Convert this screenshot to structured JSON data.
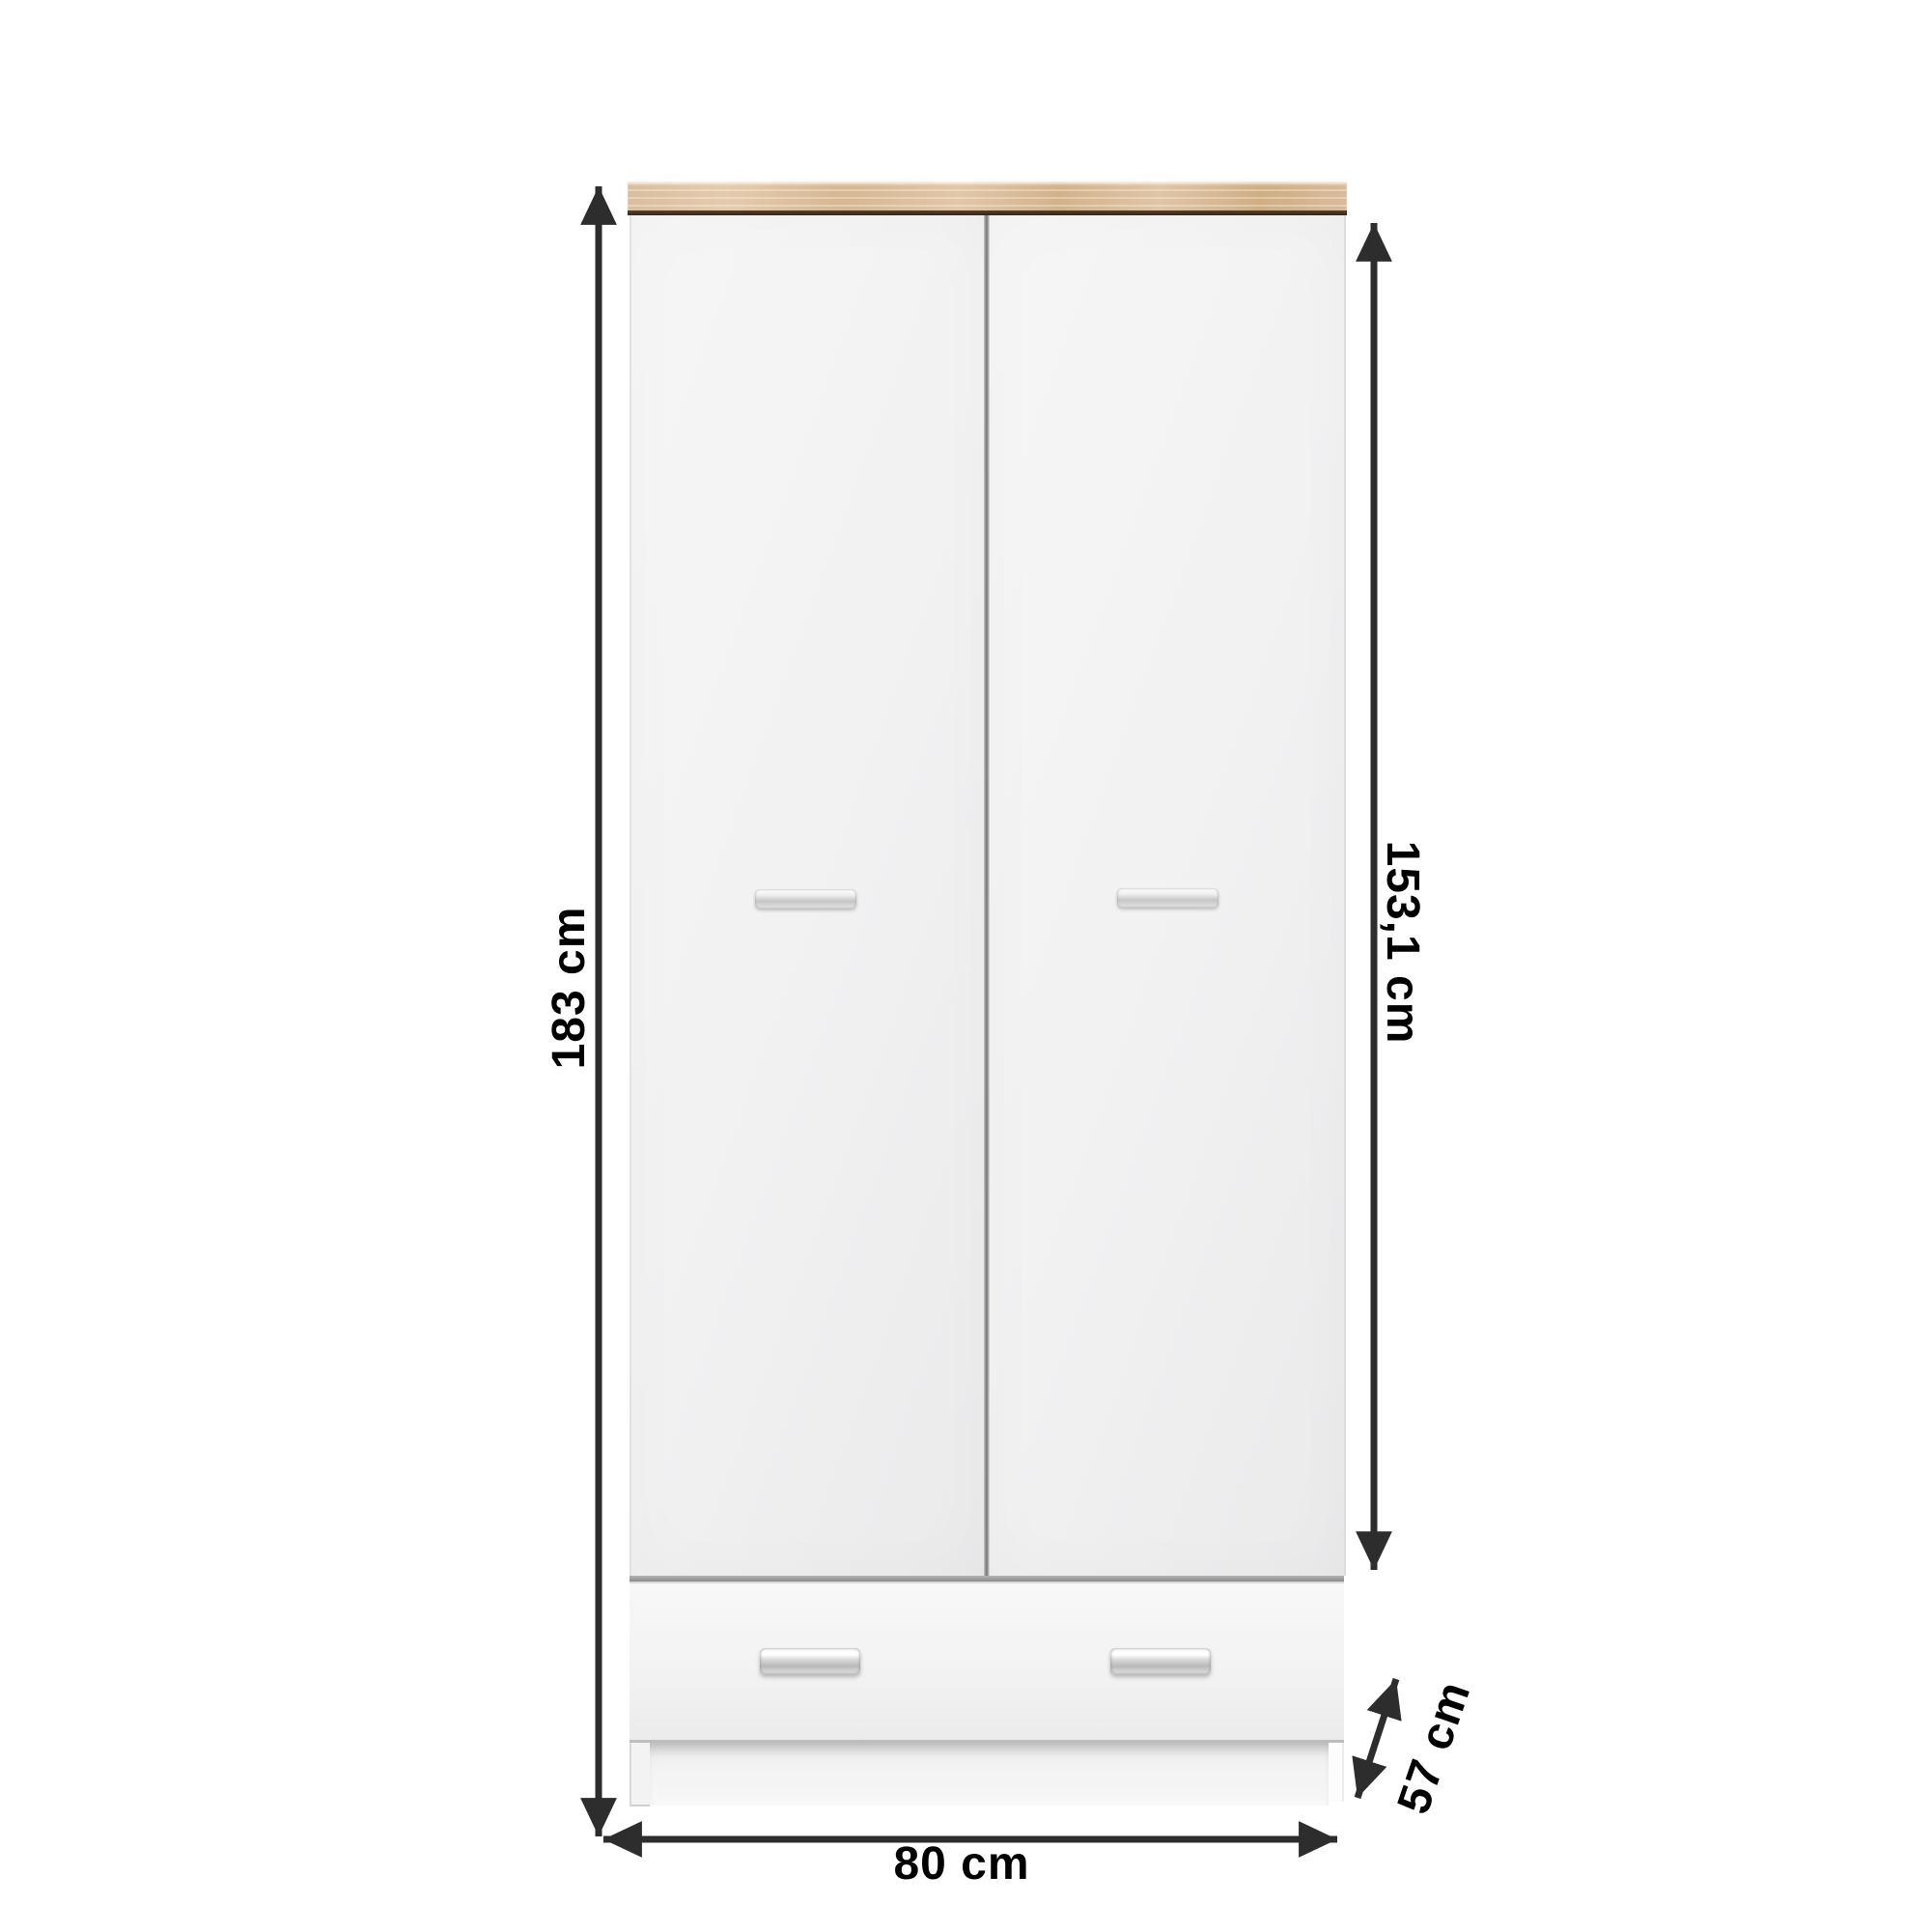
{
  "labels": {
    "overall_height": "183 cm",
    "door_height": "153,1 cm",
    "width": "80 cm",
    "depth": "57 cm"
  },
  "colors": {
    "background": "#ffffff",
    "dimension_line": "#2d2d2d",
    "label_text": "#000000",
    "wood_top": "#dcc1a3",
    "wood_edge_dark": "#3a2e21",
    "door_fill": "#f2f2f2",
    "divider": "#8f8f8f",
    "handle_metal": "#d7d7d7"
  }
}
